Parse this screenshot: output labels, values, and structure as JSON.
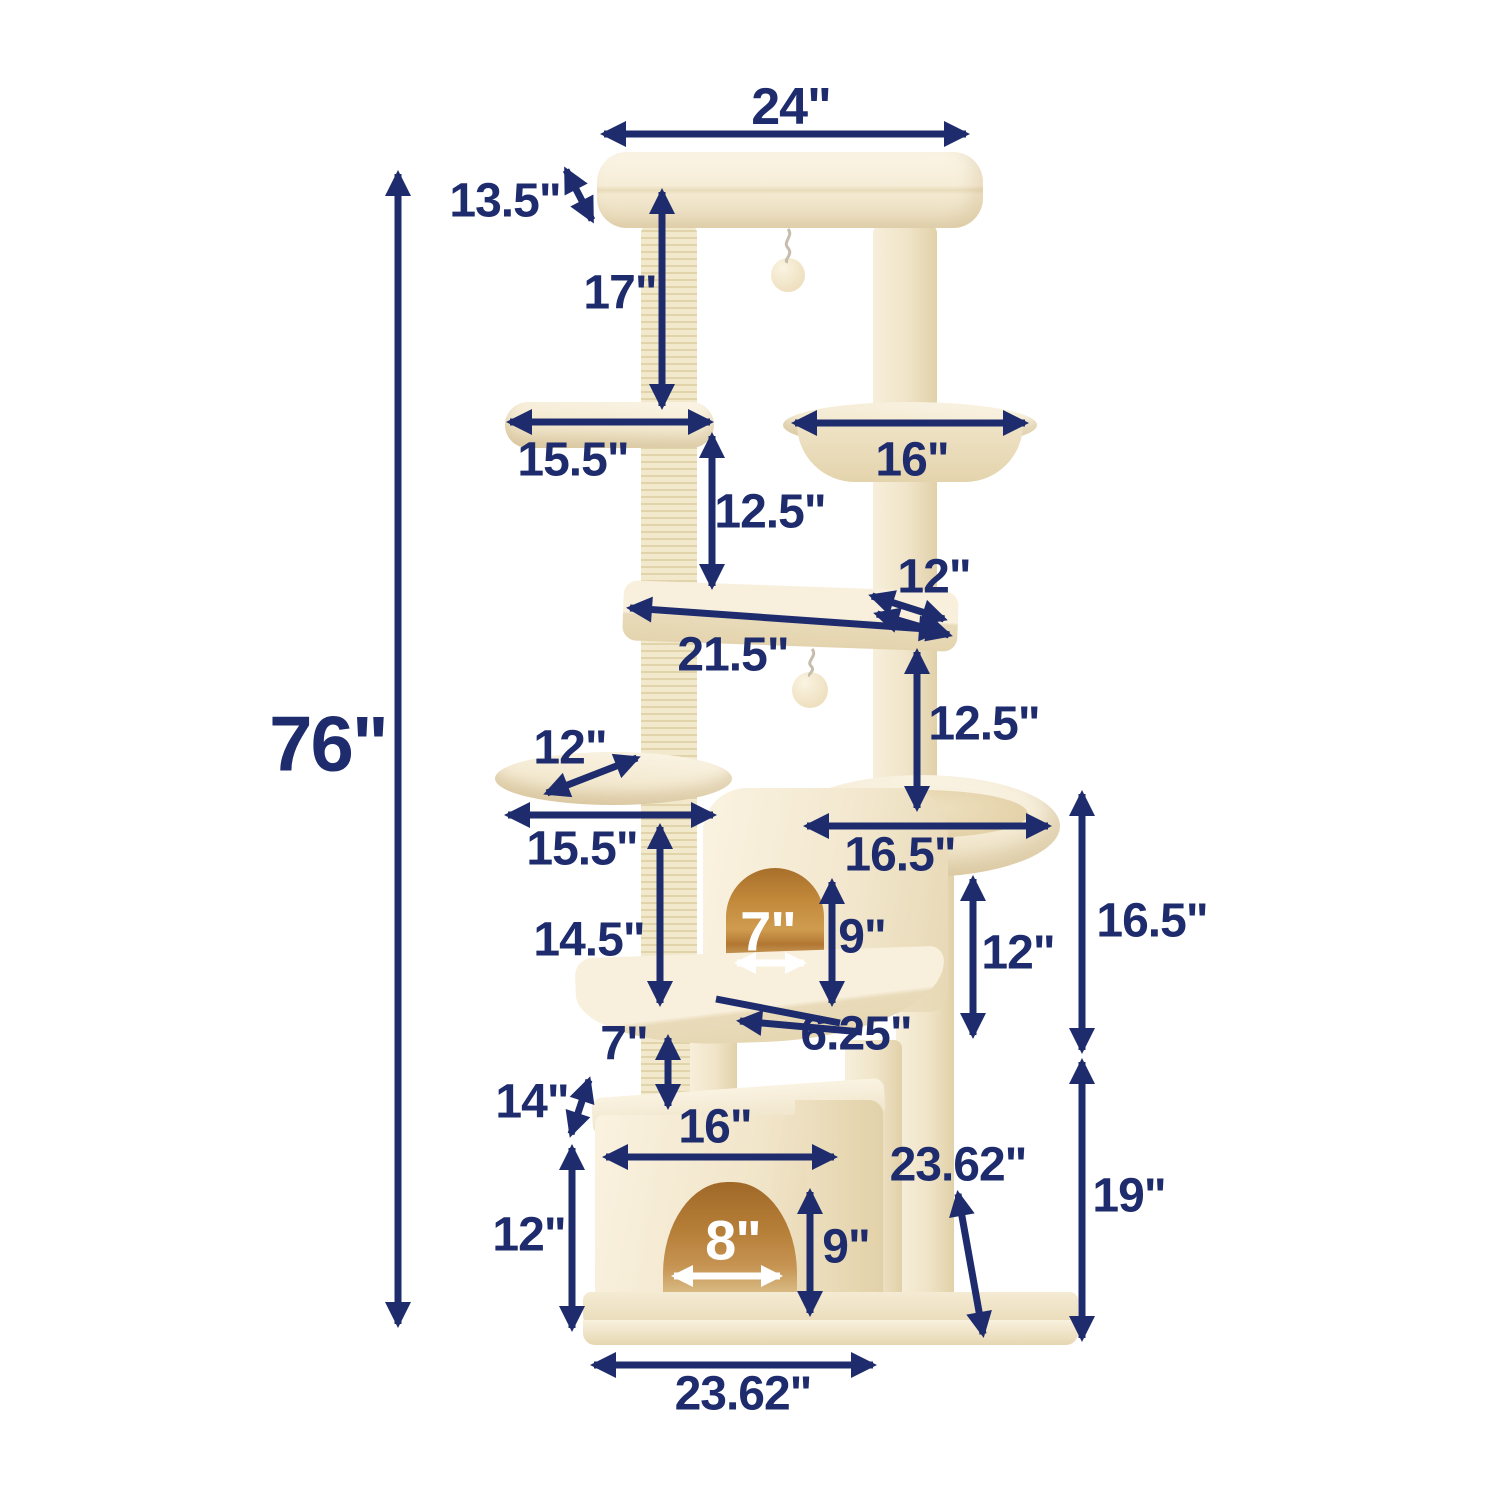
{
  "diagram": {
    "type": "product-dimension-diagram",
    "subject": "cat tree tower with condos, perches, hammock and scratching posts",
    "unit": "inches"
  },
  "colors": {
    "background": "#ffffff",
    "annotation_navy": "#1e2c6e",
    "annotation_white": "#ffffff",
    "plush_cream": "#f4ead2",
    "plush_shadow": "#e9dbb9",
    "sisal_post": "#eee4c6",
    "condo_interior_orange": "#c38a3c"
  },
  "labels": [
    {
      "id": "overall-height",
      "text": "76\""
    },
    {
      "id": "top-perch-width",
      "text": "24\""
    },
    {
      "id": "top-perch-thickness",
      "text": "13.5\""
    },
    {
      "id": "top-gap-height",
      "text": "17\""
    },
    {
      "id": "upper-left-platform-width",
      "text": "15.5\""
    },
    {
      "id": "hammock-width",
      "text": "16\""
    },
    {
      "id": "upper-gap-height",
      "text": "12.5\""
    },
    {
      "id": "corner-platform-depth",
      "text": "12\""
    },
    {
      "id": "corner-platform-width",
      "text": "21.5\""
    },
    {
      "id": "mid-gap-height",
      "text": "12.5\""
    },
    {
      "id": "small-oval-platform-depth",
      "text": "12\""
    },
    {
      "id": "small-oval-platform-width",
      "text": "15.5\""
    },
    {
      "id": "round-bed-width",
      "text": "16.5\""
    },
    {
      "id": "upper-condo-height",
      "text": "14.5\""
    },
    {
      "id": "upper-condo-door-width",
      "text": "7\""
    },
    {
      "id": "upper-condo-door-height",
      "text": "9\""
    },
    {
      "id": "bed-to-platform-height",
      "text": "12\""
    },
    {
      "id": "upper-section-height",
      "text": "16.5\""
    },
    {
      "id": "platform-thickness",
      "text": "6.25\""
    },
    {
      "id": "lower-gap-height",
      "text": "7\""
    },
    {
      "id": "lower-box-side-height",
      "text": "14\""
    },
    {
      "id": "lower-box-width",
      "text": "16\""
    },
    {
      "id": "base-diagonal-depth",
      "text": "23.62\""
    },
    {
      "id": "lower-section-height",
      "text": "19\""
    },
    {
      "id": "lower-box-height",
      "text": "12\""
    },
    {
      "id": "lower-box-door-width",
      "text": "8\""
    },
    {
      "id": "lower-box-door-height",
      "text": "9\""
    },
    {
      "id": "base-width",
      "text": "23.62\""
    }
  ]
}
